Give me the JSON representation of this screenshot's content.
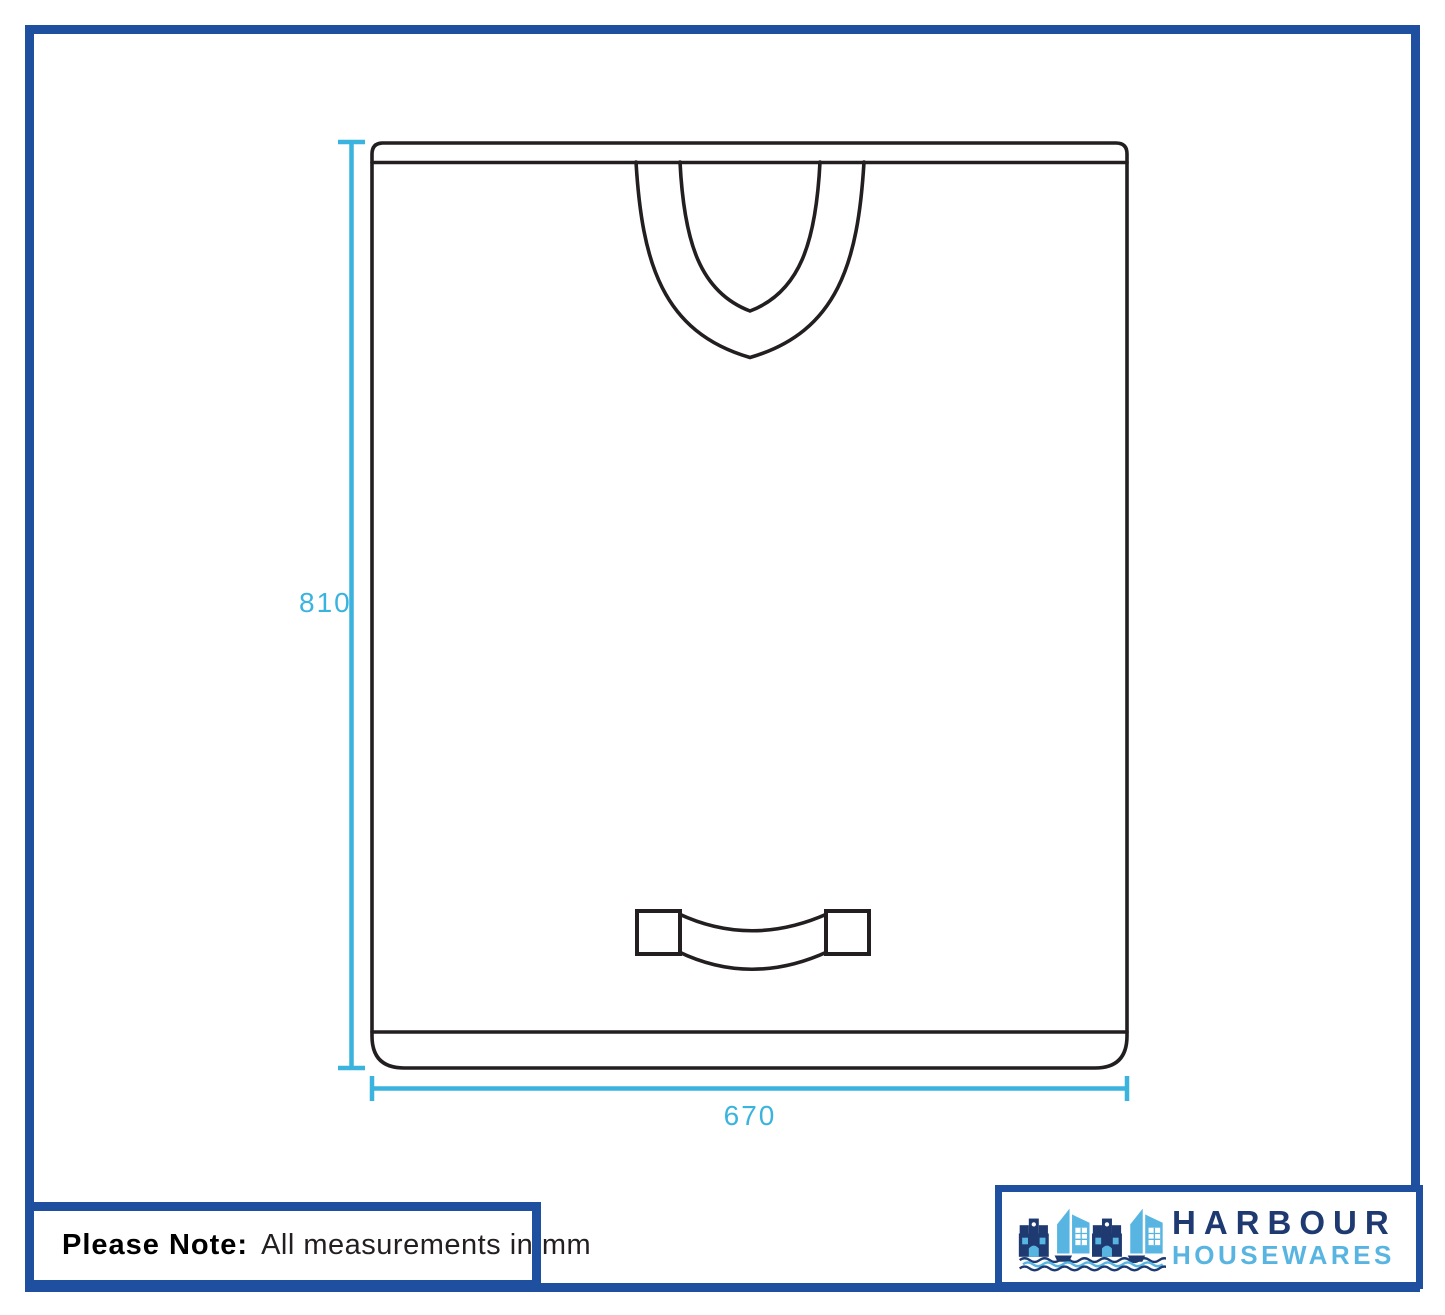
{
  "dimensions": {
    "height_mm": "810",
    "width_mm": "670"
  },
  "note": {
    "label": "Please Note:",
    "text": "All measurements in mm"
  },
  "logo": {
    "brand": "HARBOUR",
    "suffix": "HOUSEWARES"
  },
  "icons": {
    "logo_icon": "harbour-buildings-boats-icon"
  },
  "colors": {
    "frame_blue": "#1e509f",
    "dim_cyan": "#3ab4de",
    "line_black": "#231f20",
    "logo_navy": "#1e3a70",
    "logo_light_blue": "#58b5e2",
    "text_black": "#231f20"
  }
}
